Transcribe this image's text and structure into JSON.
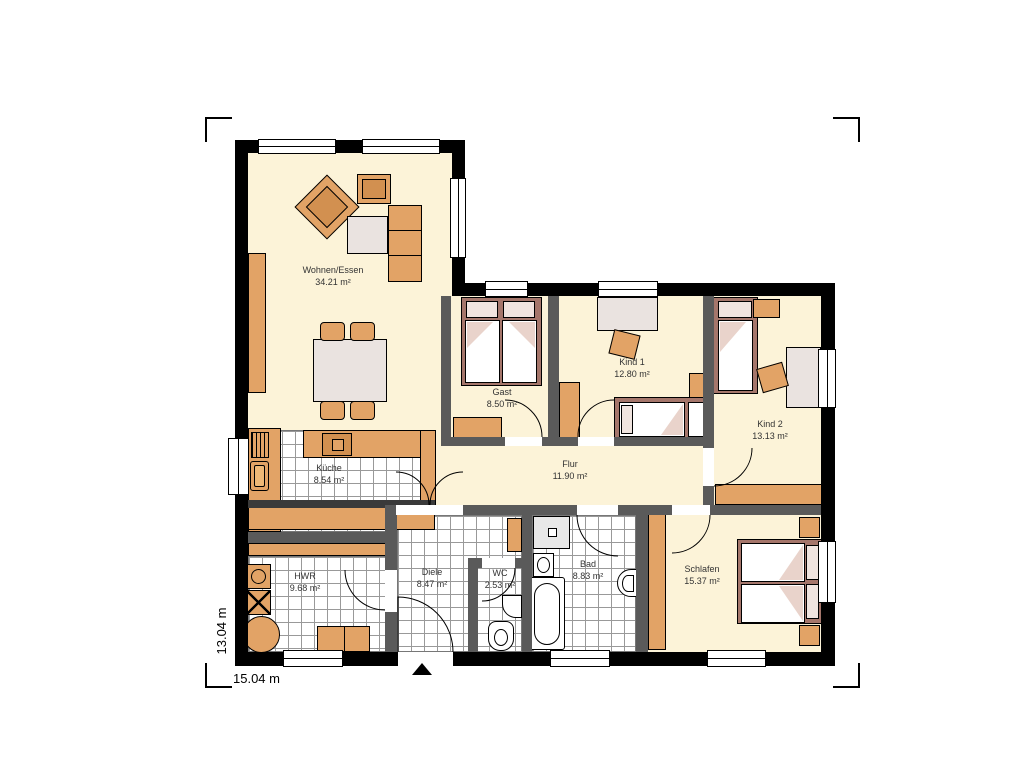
{
  "rooms": {
    "wohnen_essen": {
      "name": "Wohnen/Essen",
      "area": "34.21 m²"
    },
    "kueche": {
      "name": "Küche",
      "area": "8.54 m²"
    },
    "gast": {
      "name": "Gast",
      "area": "8.50 m²"
    },
    "kind1": {
      "name": "Kind 1",
      "area": "12.80 m²"
    },
    "kind2": {
      "name": "Kind 2",
      "area": "13.13 m²"
    },
    "flur": {
      "name": "Flur",
      "area": "11.90 m²"
    },
    "diele": {
      "name": "Diele",
      "area": "8.47 m²"
    },
    "wc": {
      "name": "WC",
      "area": "2.53 m²"
    },
    "bad": {
      "name": "Bad",
      "area": "8.83 m²"
    },
    "hwr": {
      "name": "HWR",
      "area": "9.68 m²"
    },
    "schlafen": {
      "name": "Schlafen",
      "area": "15.37 m²"
    }
  },
  "dimensions": {
    "width": "15.04 m",
    "depth": "13.04 m"
  },
  "colors": {
    "exterior_wall": "#000000",
    "interior_wall": "#5a5a5a",
    "floor": "#fcf3d8",
    "furniture_wood": "#e2a366",
    "bed_frame": "#a5766b"
  }
}
